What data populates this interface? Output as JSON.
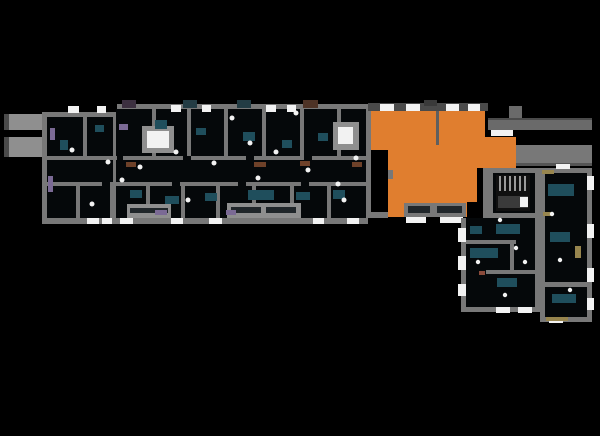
{
  "canvas": {
    "width": 600,
    "height": 436,
    "bg": "#000000"
  },
  "colors": {
    "wall": "#787878",
    "wall_dark": "#4a4a4a",
    "wall_light": "#8f8f8f",
    "room": "#05080a",
    "window": "#f2f2f2",
    "accent": "#e07e2f",
    "teal": "#1f4e5c",
    "purple": "#7b6a95",
    "brown": "#6e4129",
    "gold": "#97854e",
    "band": "#6a6a6a",
    "glass": "#20262a",
    "stair_tread": "#9a9a9a"
  },
  "floorplan": {
    "type": "building-floor-plan",
    "highlighted_unit": {
      "id": "selected-unit",
      "fill": "#e07e2f",
      "selected": true
    }
  }
}
